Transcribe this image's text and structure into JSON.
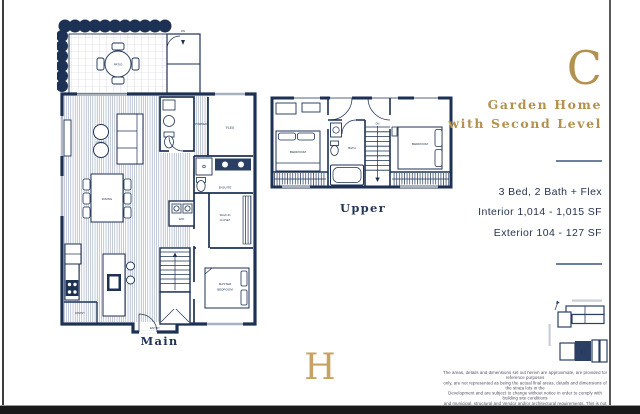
{
  "page": {
    "plan_letter": "C",
    "title_line1": "Garden Home",
    "title_line2": "with Second Level",
    "specs": [
      "3 Bed, 2 Bath + Flex",
      "Interior 1,014 - 1,015 SF",
      "Exterior 104 - 127 SF"
    ],
    "logo_letter": "H",
    "colors": {
      "navy": "#22365A",
      "plan_navy": "#1D3154",
      "gold": "#B3914E",
      "divider": "#6B7F9E"
    },
    "disclaimer": {
      "lines": [
        "The areas, details and dimensions set out herein are approximate, are provided for reference purposes",
        "only, are not represented as being the actual final areas, details and dimensions of the strata lots in the",
        "Development and are subject to change without notice in order to comply with building site conditions",
        "and municipal, structural and Vendor and/or architectural requirements. This is not an offering for sale",
        "as such an offering can only be made when accompanied by a Disclosure Statement. E.&O.E."
      ]
    }
  },
  "main_plan": {
    "title": "Main",
    "labels": {
      "patio": "PATIO",
      "dn": "DN",
      "living": "LIVING",
      "dining": "DINING",
      "pantry": "PANTRY",
      "powder": "POWDER",
      "flex": "FLEX",
      "ensuite": "ENSUITE",
      "wd": "W/D",
      "walkin1": "WALK-IN",
      "walkin2": "CLOSET",
      "master1": "MASTER",
      "master2": "BEDROOM",
      "entry": "ENTRY"
    }
  },
  "upper_plan": {
    "title": "Upper",
    "labels": {
      "bedroom": "BEDROOM",
      "bath": "BATH",
      "dn": "DN"
    }
  },
  "keyplan": {
    "unit_label": "C"
  }
}
